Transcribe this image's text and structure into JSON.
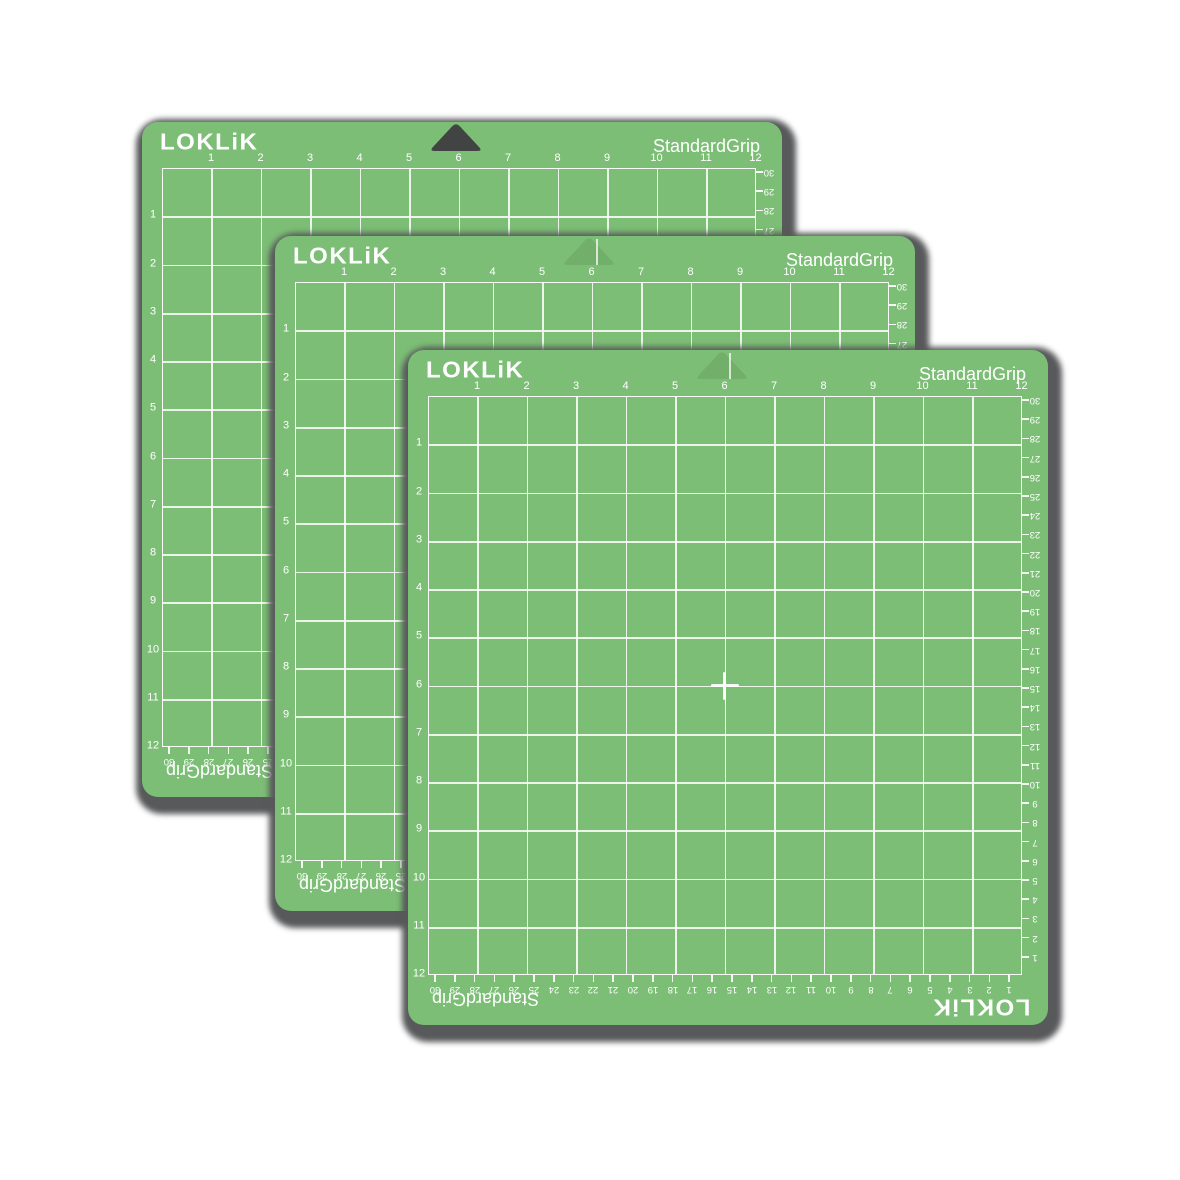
{
  "image": {
    "description_role": "product-image",
    "mat_count": 3
  },
  "mat": {
    "brand": "LOKLiK",
    "grip_label": "StandardGrip",
    "brand_mirrored": "LOKLiK",
    "grip_label_mirrored": "StandardGrip",
    "grid": {
      "columns": 12,
      "rows": 12
    },
    "top_ruler_numbers": [
      "1",
      "2",
      "3",
      "4",
      "5",
      "6",
      "7",
      "8",
      "9",
      "10",
      "11",
      "12"
    ],
    "left_ruler_numbers": [
      "1",
      "2",
      "3",
      "4",
      "5",
      "6",
      "7",
      "8",
      "9",
      "10",
      "11",
      "12"
    ],
    "right_ruler_numbers": [
      "30",
      "29",
      "28",
      "27",
      "26",
      "25",
      "24",
      "23",
      "22",
      "21",
      "20",
      "19",
      "18",
      "17",
      "16",
      "15",
      "14",
      "13",
      "12",
      "11",
      "10",
      "9",
      "8",
      "7",
      "6",
      "5",
      "4",
      "3",
      "2",
      "1"
    ],
    "bottom_ruler_numbers": [
      "30",
      "29",
      "28",
      "27",
      "26",
      "25",
      "24",
      "23",
      "22",
      "21",
      "20",
      "19",
      "18",
      "17",
      "16",
      "15",
      "14",
      "13",
      "12",
      "11",
      "10",
      "9",
      "8",
      "7",
      "6",
      "5",
      "4",
      "3",
      "2",
      "1"
    ],
    "colors": {
      "mat_green": "#7cbe76",
      "grid_line": "#ffffff",
      "shadow_gray": "#58595b",
      "notch_hole_green": "#72af6b",
      "notch_hole_dark": "#424343",
      "text_white": "#ffffff"
    }
  }
}
